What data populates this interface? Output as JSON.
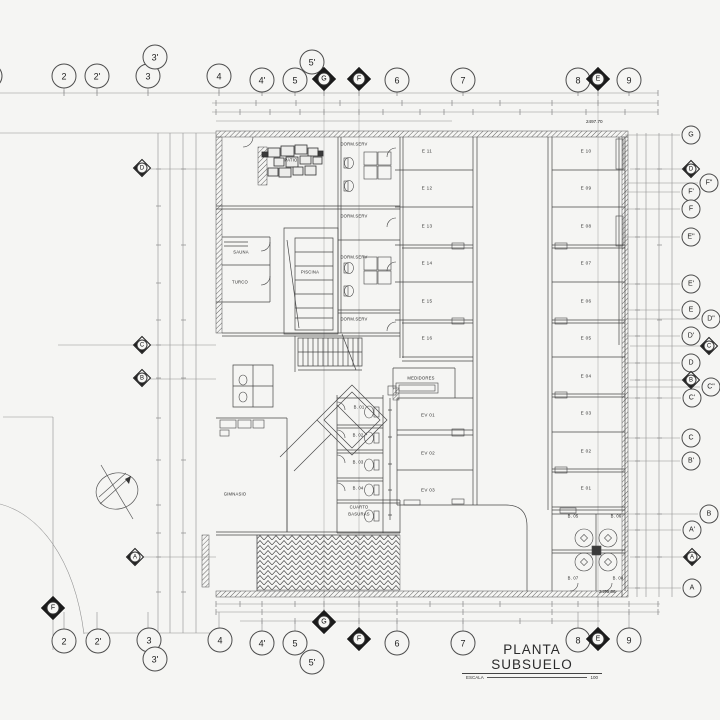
{
  "title_block": {
    "title": "PLANTA SUBSUELO",
    "scale_label": "ESCALA",
    "scale_value": "100"
  },
  "elevations": {
    "top_right": "2497.70",
    "bottom_right": "2495.06"
  },
  "grid_bubbles": {
    "top": [
      {
        "label": "",
        "x": -10,
        "y": 76,
        "shape": "circle"
      },
      {
        "label": "2",
        "x": 64,
        "y": 76,
        "shape": "circle"
      },
      {
        "label": "2'",
        "x": 97,
        "y": 76,
        "shape": "circle"
      },
      {
        "label": "3",
        "x": 148,
        "y": 76,
        "shape": "circle"
      },
      {
        "label": "3'",
        "x": 155,
        "y": 57,
        "shape": "circle"
      },
      {
        "label": "4",
        "x": 219,
        "y": 76,
        "shape": "circle"
      },
      {
        "label": "4'",
        "x": 262,
        "y": 80,
        "shape": "circle"
      },
      {
        "label": "5",
        "x": 295,
        "y": 80,
        "shape": "circle"
      },
      {
        "label": "5'",
        "x": 312,
        "y": 62,
        "shape": "circle"
      },
      {
        "label": "G",
        "x": 324,
        "y": 79,
        "shape": "diamond"
      },
      {
        "label": "F",
        "x": 359,
        "y": 79,
        "shape": "diamond"
      },
      {
        "label": "6",
        "x": 397,
        "y": 80,
        "shape": "circle"
      },
      {
        "label": "7",
        "x": 463,
        "y": 80,
        "shape": "circle"
      },
      {
        "label": "8",
        "x": 578,
        "y": 80,
        "shape": "circle"
      },
      {
        "label": "E",
        "x": 598,
        "y": 79,
        "shape": "diamond"
      },
      {
        "label": "9",
        "x": 629,
        "y": 80,
        "shape": "circle"
      }
    ],
    "bottom": [
      {
        "label": "F",
        "x": 53,
        "y": 608,
        "shape": "diamond"
      },
      {
        "label": "2",
        "x": 64,
        "y": 641,
        "shape": "circle"
      },
      {
        "label": "2'",
        "x": 98,
        "y": 641,
        "shape": "circle"
      },
      {
        "label": "3",
        "x": 149,
        "y": 640,
        "shape": "circle"
      },
      {
        "label": "3'",
        "x": 155,
        "y": 659,
        "shape": "circle"
      },
      {
        "label": "4",
        "x": 220,
        "y": 640,
        "shape": "circle"
      },
      {
        "label": "4'",
        "x": 262,
        "y": 643,
        "shape": "circle"
      },
      {
        "label": "5",
        "x": 295,
        "y": 643,
        "shape": "circle"
      },
      {
        "label": "5'",
        "x": 312,
        "y": 662,
        "shape": "circle"
      },
      {
        "label": "G",
        "x": 324,
        "y": 622,
        "shape": "diamond"
      },
      {
        "label": "F",
        "x": 359,
        "y": 639,
        "shape": "diamond"
      },
      {
        "label": "6",
        "x": 397,
        "y": 643,
        "shape": "circle"
      },
      {
        "label": "7",
        "x": 463,
        "y": 643,
        "shape": "circle"
      },
      {
        "label": "8",
        "x": 578,
        "y": 640,
        "shape": "circle"
      },
      {
        "label": "E",
        "x": 598,
        "y": 639,
        "shape": "diamond"
      },
      {
        "label": "9",
        "x": 629,
        "y": 640,
        "shape": "circle"
      }
    ],
    "right": [
      {
        "label": "G",
        "x": 691,
        "y": 135,
        "shape": "circle"
      },
      {
        "label": "D",
        "x": 691,
        "y": 169,
        "shape": "diamond"
      },
      {
        "label": "F\"",
        "x": 709,
        "y": 183,
        "shape": "circle"
      },
      {
        "label": "F'",
        "x": 691,
        "y": 192,
        "shape": "circle"
      },
      {
        "label": "F",
        "x": 691,
        "y": 209,
        "shape": "circle"
      },
      {
        "label": "E\"",
        "x": 691,
        "y": 237,
        "shape": "circle"
      },
      {
        "label": "E'",
        "x": 691,
        "y": 284,
        "shape": "circle"
      },
      {
        "label": "E",
        "x": 691,
        "y": 310,
        "shape": "circle"
      },
      {
        "label": "D\"",
        "x": 711,
        "y": 319,
        "shape": "circle"
      },
      {
        "label": "D'",
        "x": 691,
        "y": 336,
        "shape": "circle"
      },
      {
        "label": "C",
        "x": 709,
        "y": 346,
        "shape": "diamond"
      },
      {
        "label": "D",
        "x": 691,
        "y": 363,
        "shape": "circle"
      },
      {
        "label": "B",
        "x": 691,
        "y": 380,
        "shape": "diamond"
      },
      {
        "label": "C\"",
        "x": 711,
        "y": 387,
        "shape": "circle"
      },
      {
        "label": "C'",
        "x": 692,
        "y": 398,
        "shape": "circle"
      },
      {
        "label": "C",
        "x": 691,
        "y": 438,
        "shape": "circle"
      },
      {
        "label": "B'",
        "x": 691,
        "y": 461,
        "shape": "circle"
      },
      {
        "label": "B",
        "x": 709,
        "y": 514,
        "shape": "circle"
      },
      {
        "label": "A'",
        "x": 692,
        "y": 530,
        "shape": "circle"
      },
      {
        "label": "A",
        "x": 692,
        "y": 557,
        "shape": "diamond"
      },
      {
        "label": "A",
        "x": 692,
        "y": 588,
        "shape": "circle"
      }
    ],
    "left": [
      {
        "label": "D",
        "x": 142,
        "y": 168,
        "shape": "diamond"
      },
      {
        "label": "C",
        "x": 142,
        "y": 345,
        "shape": "diamond"
      },
      {
        "label": "B",
        "x": 142,
        "y": 378,
        "shape": "diamond"
      },
      {
        "label": "A",
        "x": 135,
        "y": 557,
        "shape": "diamond"
      }
    ]
  },
  "room_labels": [
    {
      "text": "PATIO",
      "x": 291,
      "y": 160
    },
    {
      "text": "DORM.SERV",
      "x": 354,
      "y": 144
    },
    {
      "text": "DORM.SERV",
      "x": 354,
      "y": 216
    },
    {
      "text": "DORM.SERV",
      "x": 354,
      "y": 257
    },
    {
      "text": "DORM.SERV",
      "x": 354,
      "y": 319
    },
    {
      "text": "SAUNA",
      "x": 241,
      "y": 252
    },
    {
      "text": "TURCO",
      "x": 240,
      "y": 282
    },
    {
      "text": "PISCINA",
      "x": 310,
      "y": 272
    },
    {
      "text": "MEDIDORES",
      "x": 421,
      "y": 378
    },
    {
      "text": "GIMNASIO",
      "x": 235,
      "y": 494
    },
    {
      "text": "CUARTO",
      "x": 359,
      "y": 507
    },
    {
      "text": "BASURAS",
      "x": 359,
      "y": 514
    },
    {
      "text": "B. 01",
      "x": 359,
      "y": 407
    },
    {
      "text": "B. 02",
      "x": 358,
      "y": 435
    },
    {
      "text": "B. 03",
      "x": 358,
      "y": 462
    },
    {
      "text": "B. 04",
      "x": 358,
      "y": 488
    },
    {
      "text": "B. 05",
      "x": 573,
      "y": 516
    },
    {
      "text": "B. 06",
      "x": 616,
      "y": 516
    },
    {
      "text": "B. 07",
      "x": 573,
      "y": 578
    },
    {
      "text": "B. 08",
      "x": 618,
      "y": 578
    }
  ],
  "parking_labels": [
    {
      "text": "E 11",
      "x": 427,
      "y": 151
    },
    {
      "text": "E 12",
      "x": 427,
      "y": 188
    },
    {
      "text": "E 13",
      "x": 427,
      "y": 226
    },
    {
      "text": "E 14",
      "x": 427,
      "y": 263
    },
    {
      "text": "E 15",
      "x": 427,
      "y": 301
    },
    {
      "text": "E 16",
      "x": 427,
      "y": 338
    },
    {
      "text": "E 10",
      "x": 586,
      "y": 151
    },
    {
      "text": "E 09",
      "x": 586,
      "y": 188
    },
    {
      "text": "E 08",
      "x": 586,
      "y": 226
    },
    {
      "text": "E 07",
      "x": 586,
      "y": 263
    },
    {
      "text": "E 06",
      "x": 586,
      "y": 301
    },
    {
      "text": "E 05",
      "x": 586,
      "y": 338
    },
    {
      "text": "E 04",
      "x": 586,
      "y": 376
    },
    {
      "text": "E 03",
      "x": 586,
      "y": 413
    },
    {
      "text": "E 02",
      "x": 586,
      "y": 451
    },
    {
      "text": "E 01",
      "x": 586,
      "y": 488
    },
    {
      "text": "EV 01",
      "x": 428,
      "y": 415
    },
    {
      "text": "EV 02",
      "x": 428,
      "y": 453
    },
    {
      "text": "EV 03",
      "x": 428,
      "y": 490
    }
  ]
}
